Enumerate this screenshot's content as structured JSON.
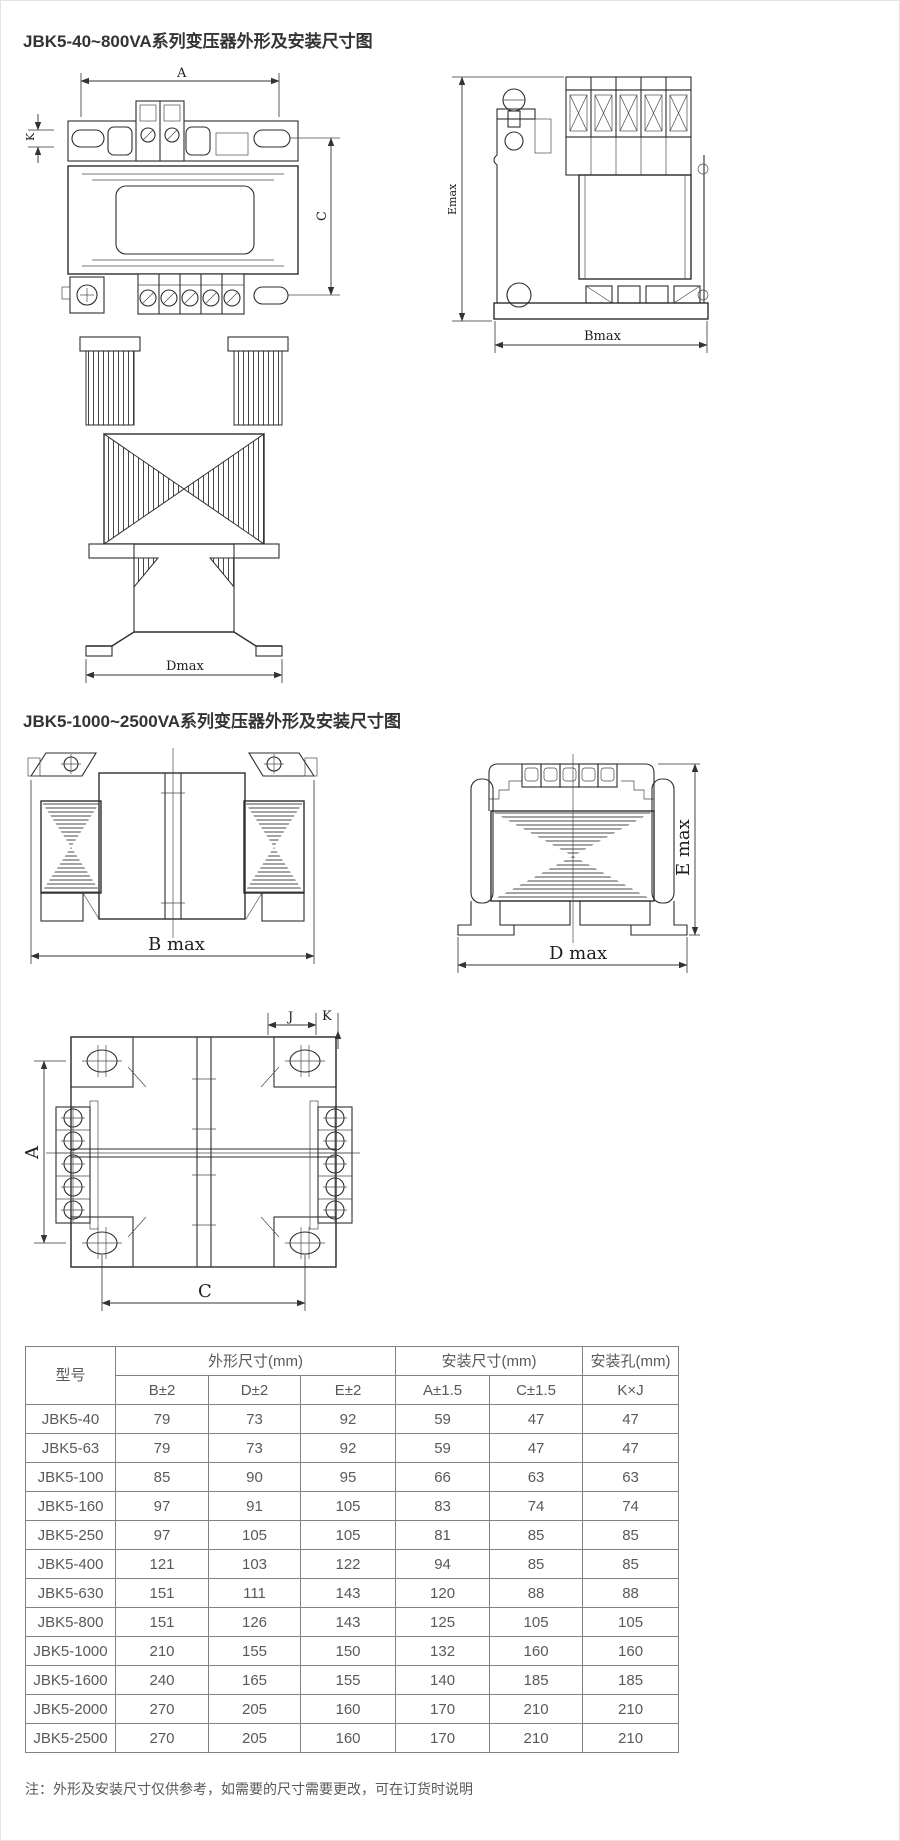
{
  "sections": {
    "s1_title": "JBK5-40~800VA系列变压器外形及安装尺寸图",
    "s2_title": "JBK5-1000~2500VA系列变压器外形及安装尺寸图",
    "note": "注：外形及安装尺寸仅供参考，如需要的尺寸需要更改，可在订货时说明"
  },
  "dims": {
    "front_small": {
      "a": "A",
      "k": "K",
      "c": "C"
    },
    "side_small": {
      "emax": "Emax",
      "bmax": "Bmax"
    },
    "coil_small": {
      "dmax": "Dmax"
    },
    "front_large": {
      "bmax": "B max"
    },
    "side_large": {
      "dmax": "D max",
      "emax": "E max"
    },
    "top_large": {
      "a": "A",
      "c": "C",
      "j": "J",
      "k": "K"
    }
  },
  "table": {
    "model_header": "型号",
    "groups": [
      {
        "label": "外形尺寸(mm)"
      },
      {
        "label": "安装尺寸(mm)"
      },
      {
        "label": "安装孔(mm)"
      }
    ],
    "sub_headers": [
      "B±2",
      "D±2",
      "E±2",
      "A±1.5",
      "C±1.5",
      "K×J"
    ],
    "rows": [
      {
        "model": "JBK5-40",
        "values": [
          "79",
          "73",
          "92",
          "59",
          "47",
          "47"
        ]
      },
      {
        "model": "JBK5-63",
        "values": [
          "79",
          "73",
          "92",
          "59",
          "47",
          "47"
        ]
      },
      {
        "model": "JBK5-100",
        "values": [
          "85",
          "90",
          "95",
          "66",
          "63",
          "63"
        ]
      },
      {
        "model": "JBK5-160",
        "values": [
          "97",
          "91",
          "105",
          "83",
          "74",
          "74"
        ]
      },
      {
        "model": "JBK5-250",
        "values": [
          "97",
          "105",
          "105",
          "81",
          "85",
          "85"
        ]
      },
      {
        "model": "JBK5-400",
        "values": [
          "121",
          "103",
          "122",
          "94",
          "85",
          "85"
        ]
      },
      {
        "model": "JBK5-630",
        "values": [
          "151",
          "111",
          "143",
          "120",
          "88",
          "88"
        ]
      },
      {
        "model": "JBK5-800",
        "values": [
          "151",
          "126",
          "143",
          "125",
          "105",
          "105"
        ]
      },
      {
        "model": "JBK5-1000",
        "values": [
          "210",
          "155",
          "150",
          "132",
          "160",
          "160"
        ]
      },
      {
        "model": "JBK5-1600",
        "values": [
          "240",
          "165",
          "155",
          "140",
          "185",
          "185"
        ]
      },
      {
        "model": "JBK5-2000",
        "values": [
          "270",
          "205",
          "160",
          "170",
          "210",
          "210"
        ]
      },
      {
        "model": "JBK5-2500",
        "values": [
          "270",
          "205",
          "160",
          "170",
          "210",
          "210"
        ]
      }
    ]
  }
}
